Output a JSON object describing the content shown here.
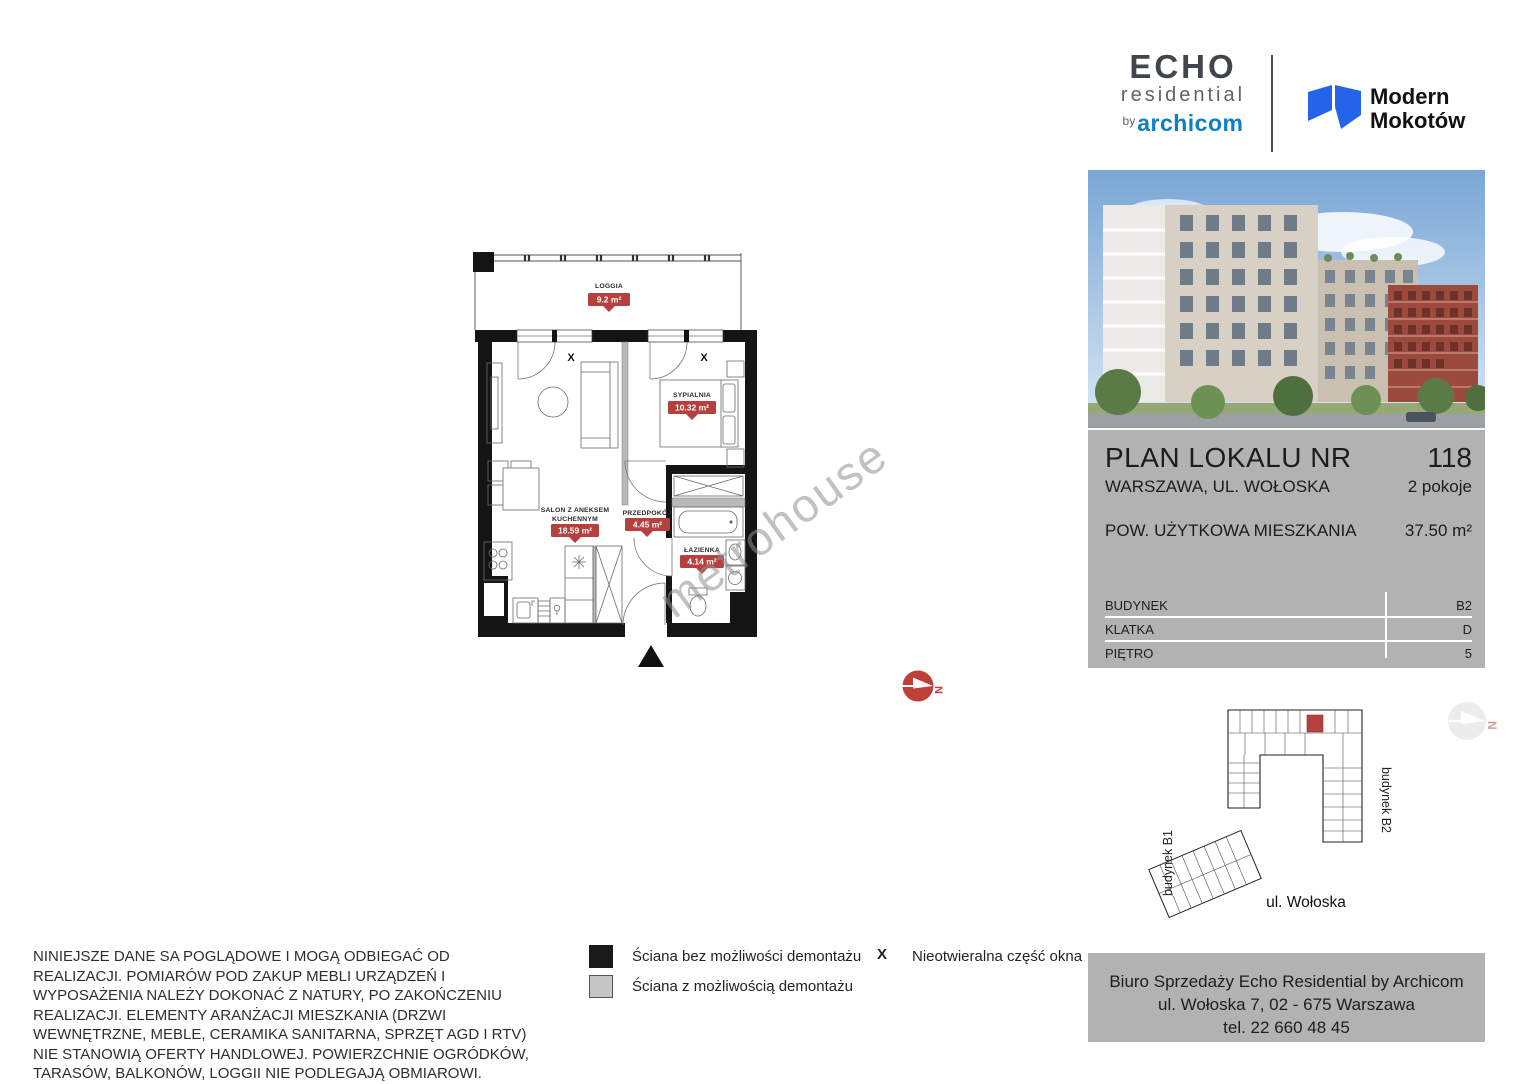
{
  "brand": {
    "echo_line1": "ECHO",
    "echo_line2": "residential",
    "echo_by": "by",
    "echo_company": "archicom",
    "project_line1": "Modern",
    "project_line2": "Mokotów",
    "colors": {
      "echo_dark": "#40464b",
      "archicom_blue": "#0d7fc3",
      "project_blue": "#2563eb"
    }
  },
  "plan_header": {
    "title": "PLAN LOKALU NR",
    "number": "118",
    "address": "WARSZAWA, UL. WOŁOSKA",
    "rooms": "2 pokoje",
    "area_label": "POW. UŻYTKOWA MIESZKANIA",
    "area_value": "37.50 m²"
  },
  "details_table": {
    "rows": [
      {
        "label": "BUDYNEK",
        "value": "B2"
      },
      {
        "label": "KLATKA",
        "value": "D"
      },
      {
        "label": "PIĘTRO",
        "value": "5"
      }
    ]
  },
  "floor_plan": {
    "loggia": {
      "name": "LOGGIA",
      "area": "9.2 m²"
    },
    "sypialnia": {
      "name": "SYPIALNIA",
      "area": "10.32 m²"
    },
    "salon": {
      "name_line1": "SALON Z ANEKSEM",
      "name_line2": "KUCHENNYM",
      "area": "18.59 m²"
    },
    "przedpokoj": {
      "name": "PRZEDPOKÓJ",
      "area": "4.45 m²"
    },
    "lazienka": {
      "name": "ŁAZIENKA",
      "area": "4.14 m²"
    },
    "window_mark": "X",
    "north_letter": "N",
    "badge_color": "#b6403d",
    "panel_gray": "#b2b2b2"
  },
  "watermark": {
    "text": "metrohouse"
  },
  "site_plan": {
    "building_b1_label": "budynek B1",
    "building_b2_label": "budynek B2",
    "street_label": "ul. Wołoska",
    "north_letter": "N",
    "unit_color": "#b6403d"
  },
  "legend": {
    "items": [
      {
        "swatch": "black",
        "label": "Ściana bez możliwości demontażu"
      },
      {
        "swatch": "gray",
        "label": "Ściana z możliwością demontażu"
      },
      {
        "symbol": "X",
        "label": "Nieotwieralna część okna"
      }
    ]
  },
  "disclaimer": {
    "text": "NINIEJSZE DANE SA POGLĄDOWE I MOGĄ ODBIEGAĆ OD REALIZACJI. POMIARÓW POD ZAKUP MEBLI URZĄDZEŃ I WYPOSAŻENIA NALEŻY DOKONAĆ Z NATURY, PO ZAKOŃCZENIU REALIZACJI. ELEMENTY ARANŻACJI MIESZKANIA (DRZWI WEWNĘTRZNE, MEBLE, CERAMIKA SANITARNA, SPRZĘT AGD I RTV) NIE STANOWIĄ OFERTY HANDLOWEJ. POWIERZCHNIE OGRÓDKÓW, TARASÓW, BALKONÓW, LOGGII NIE PODLEGAJĄ OBMIAROWI."
  },
  "contact": {
    "line1": "Biuro Sprzedaży Echo Residential by Archicom",
    "line2": "ul. Wołoska 7, 02 - 675 Warszawa",
    "line3": "tel. 22 660 48 45"
  }
}
